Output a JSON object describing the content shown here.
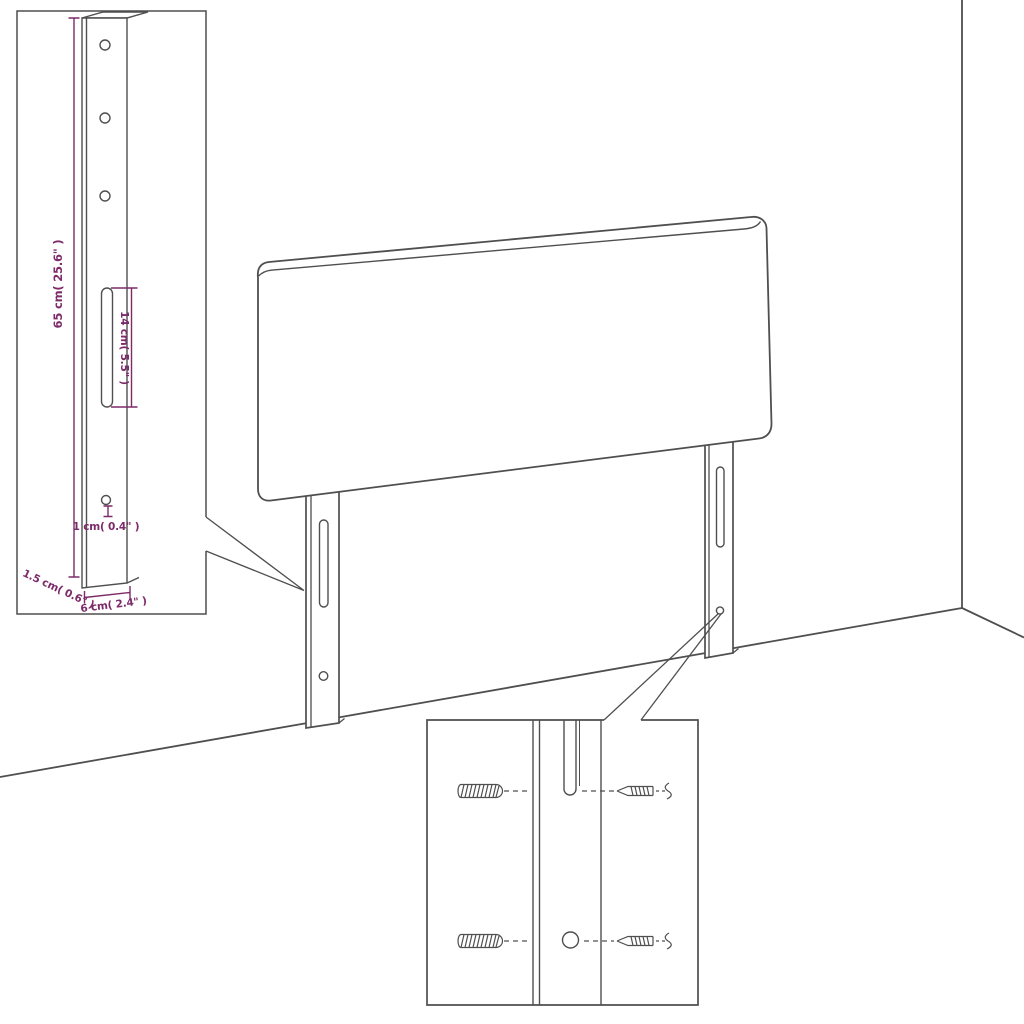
{
  "diagram": {
    "insets": {
      "leg_dimensions": {
        "height": "65 cm( 25.6\" )",
        "slot_height": "14 cm( 5.5\" )",
        "hole": "1 cm( 0.4\" )",
        "depth": "1.5 cm( 0.6\" )",
        "width": "6 cm( 2.4\" )"
      },
      "mounting_hardware": {
        "items": [
          "wall-plug",
          "screw"
        ]
      }
    },
    "colors": {
      "dimension_accent": "#7C2A69",
      "line": "#4F4F4F",
      "background": "#FFFFFF"
    }
  }
}
